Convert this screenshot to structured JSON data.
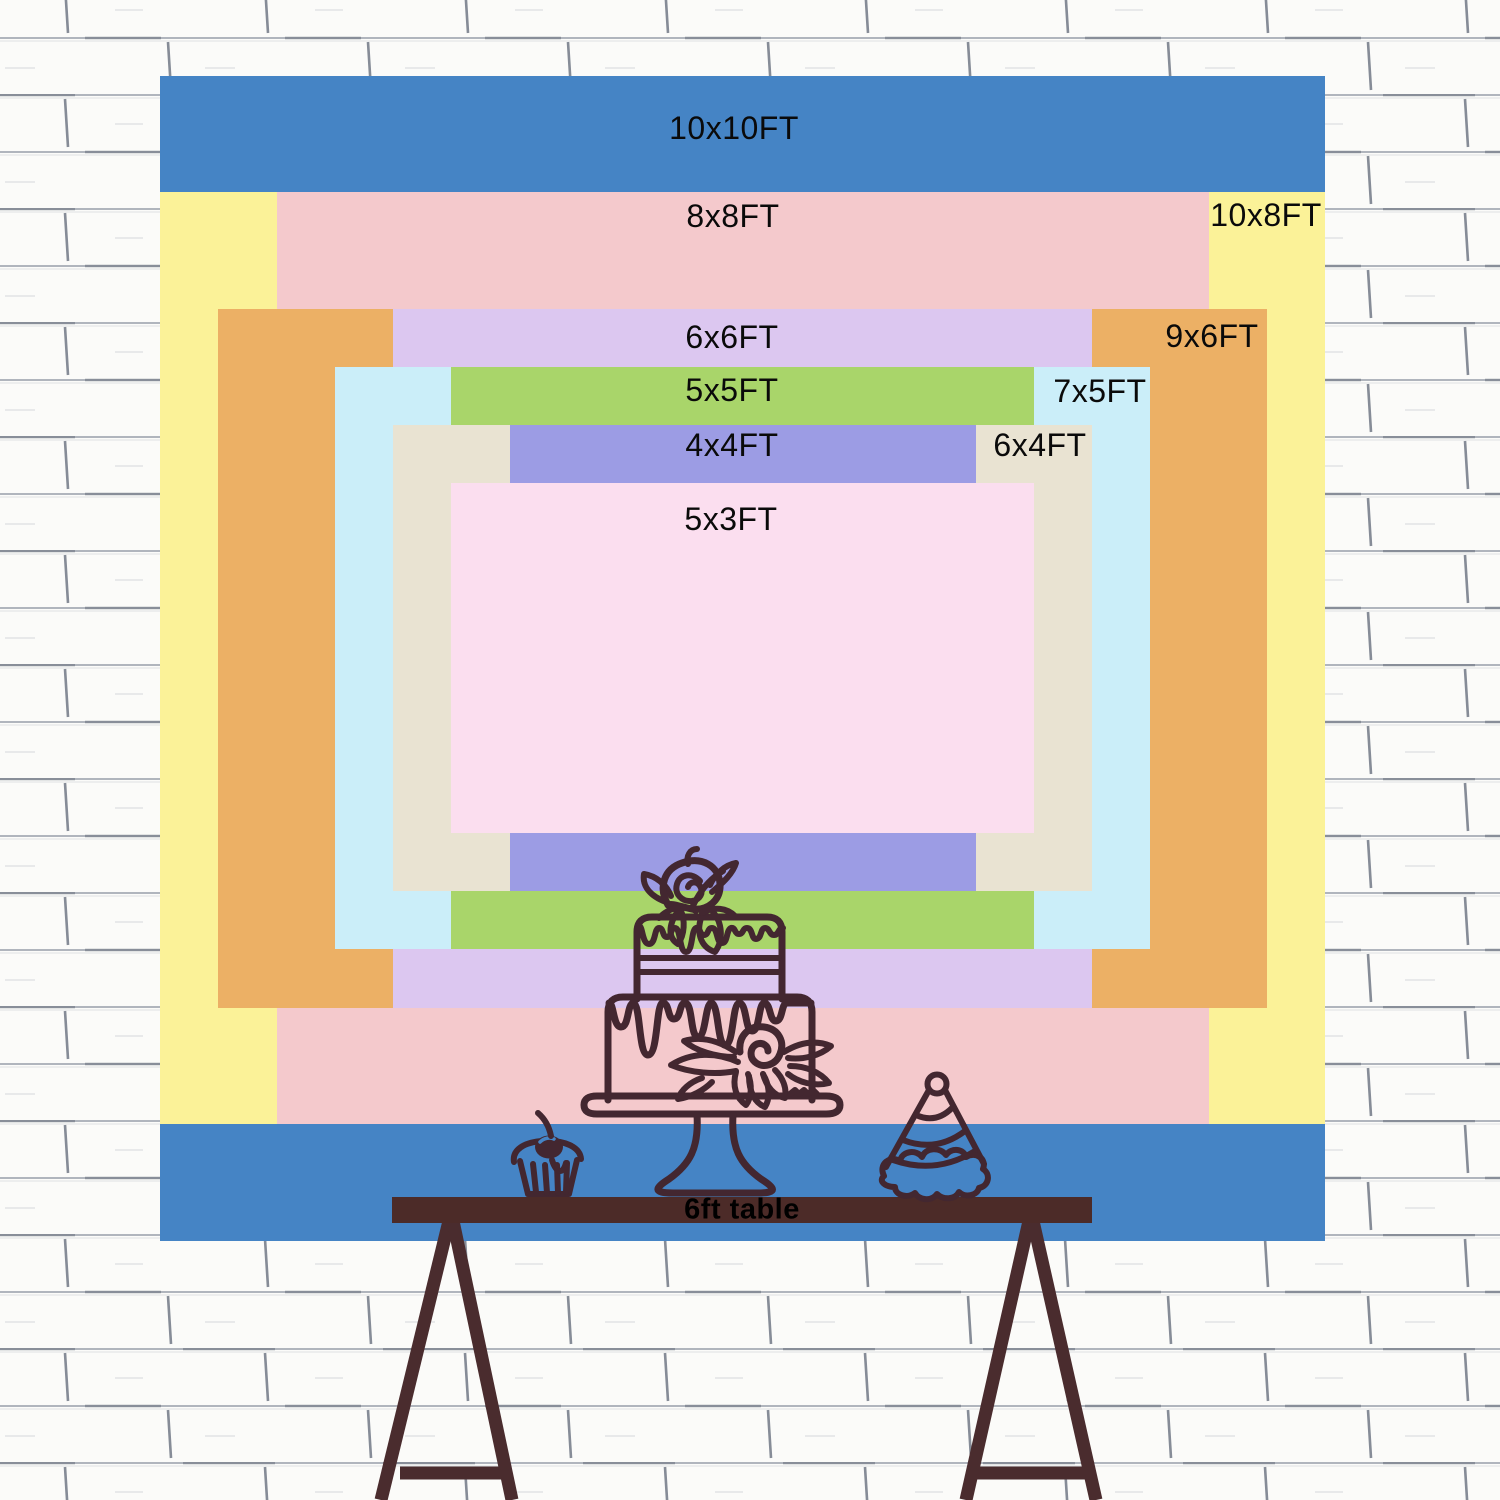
{
  "chart_title": "Backdrop size comparison chart",
  "backdrop_layers": [
    {
      "id": "10x10",
      "label": "10x10FT",
      "width_ft": 10,
      "height_ft": 10,
      "color": "#4584C5"
    },
    {
      "id": "10x8",
      "label": "10x8FT",
      "width_ft": 10,
      "height_ft": 8,
      "color": "#FBF298"
    },
    {
      "id": "8x8",
      "label": "8x8FT",
      "width_ft": 8,
      "height_ft": 8,
      "color": "#F4C9CC"
    },
    {
      "id": "9x6",
      "label": "9x6FT",
      "width_ft": 9,
      "height_ft": 6,
      "color": "#ECB065"
    },
    {
      "id": "6x6",
      "label": "6x6FT",
      "width_ft": 6,
      "height_ft": 6,
      "color": "#DCC7F0"
    },
    {
      "id": "7x5",
      "label": "7x5FT",
      "width_ft": 7,
      "height_ft": 5,
      "color": "#CBEEF9"
    },
    {
      "id": "5x5",
      "label": "5x5FT",
      "width_ft": 5,
      "height_ft": 5,
      "color": "#A9D56A"
    },
    {
      "id": "6x4",
      "label": "6x4FT",
      "width_ft": 6,
      "height_ft": 4,
      "color": "#E9E3D2"
    },
    {
      "id": "4x4",
      "label": "4x4FT",
      "width_ft": 4,
      "height_ft": 4,
      "color": "#9C9CE4"
    },
    {
      "id": "5x3",
      "label": "5x3FT",
      "width_ft": 5,
      "height_ft": 3,
      "color": "#FBDEEF"
    }
  ],
  "table": {
    "label": "6ft table",
    "length_ft": 6
  },
  "colors": {
    "outline": "#432730",
    "table": "#4C2B28",
    "legs": "#4A2C2E",
    "blue_band": "#4584C5",
    "wall_base": "#fbfbf9",
    "wall_line": "#b0b5bd",
    "wall_line_dark": "#7e8490",
    "label_text": "#0a0a0a"
  },
  "icons": [
    "cake-icon",
    "cupcake-icon",
    "cherry-icon",
    "party-hat-icon",
    "rose-icon",
    "table-legs"
  ]
}
